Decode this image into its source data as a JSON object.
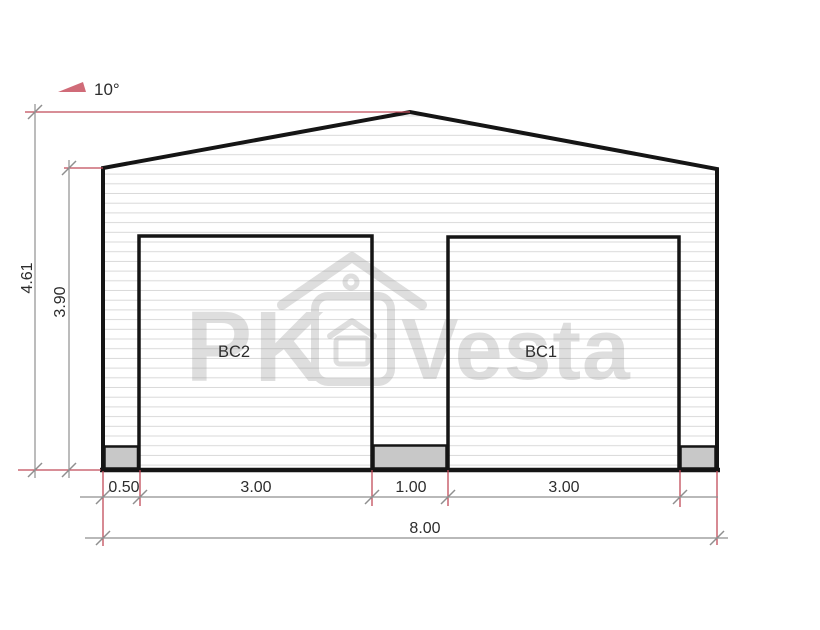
{
  "dimensions": {
    "roof_angle": "10°",
    "total_height": "4.61",
    "wall_height": "3.90",
    "bottom_segments": [
      "0.50",
      "3.00",
      "1.00",
      "3.00"
    ],
    "total_width": "8.00"
  },
  "doors": [
    {
      "label": "BC2"
    },
    {
      "label": "BC1"
    }
  ],
  "watermark": {
    "brand_left": "PK",
    "brand_right": "Vesta"
  },
  "colors": {
    "outline": "#151515",
    "siding_line": "#d9d9d9",
    "dimension_line": "#8f8f8f",
    "extension_line": "#c14a59",
    "label_text": "#2d2d2d",
    "block_fill": "#c8c8c8",
    "watermark_gray": "#9a9a9a",
    "angle_symbol": "#c0394b"
  }
}
